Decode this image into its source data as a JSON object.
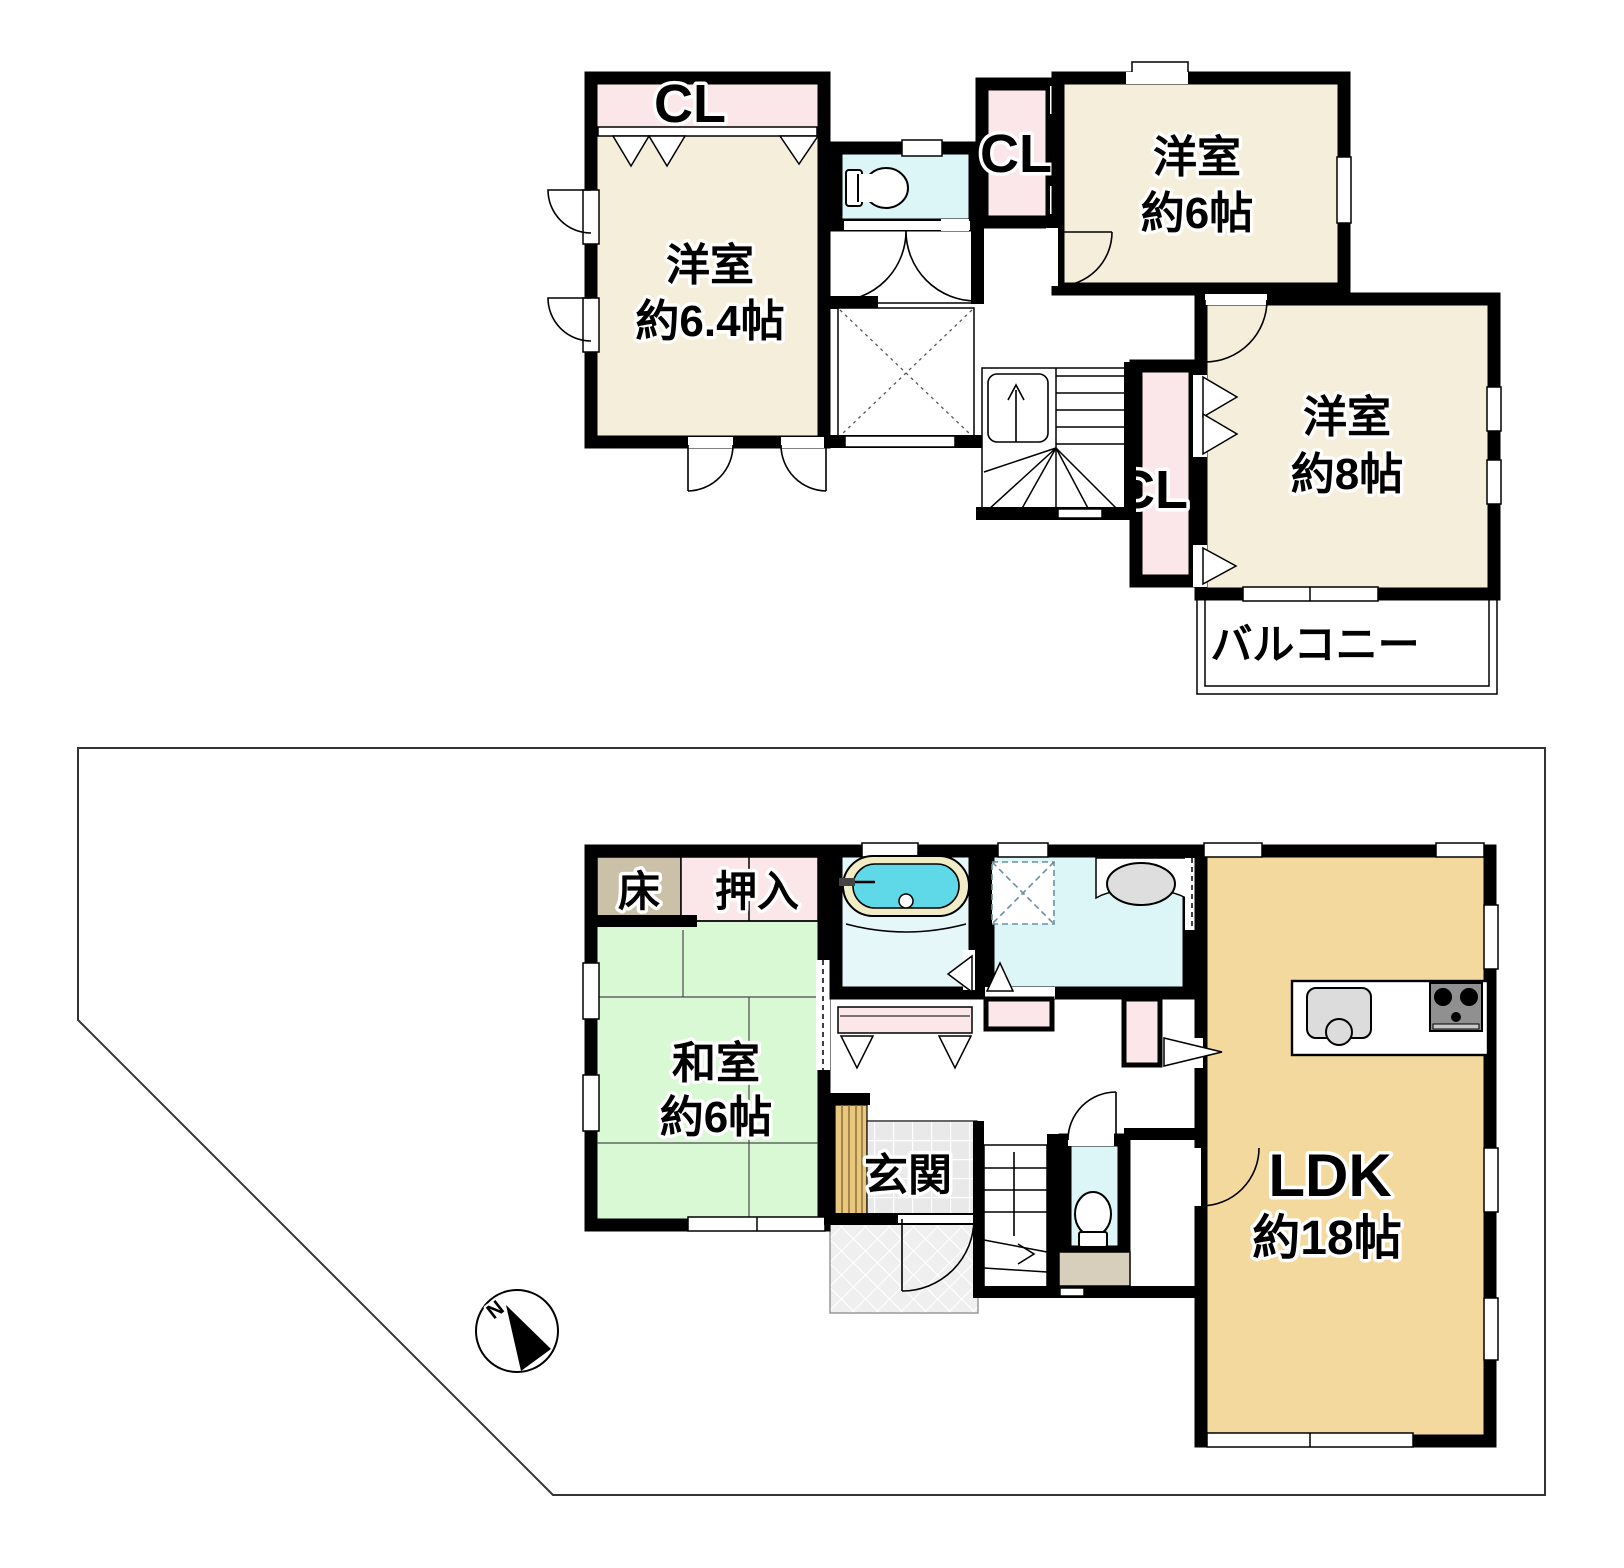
{
  "floor2": {
    "room_a_closet": "CL",
    "room_a": {
      "label": "洋室",
      "size": "約6.4帖"
    },
    "hall_closet": "CL",
    "room_b": {
      "label": "洋室",
      "size": "約6帖"
    },
    "room_c": {
      "label": "洋室",
      "size": "約8帖"
    },
    "room_c_closet": "CL",
    "balcony": "バルコニー"
  },
  "floor1": {
    "tokonoma": "床",
    "oshiire": "押入",
    "washitsu": {
      "label": "和室",
      "size": "約6帖"
    },
    "genkan": "玄関",
    "ldk": {
      "label": "LDK",
      "size": "約18帖"
    },
    "compass_north": "N"
  },
  "colors": {
    "wall": "#000000",
    "western_room": "#F5EEDA",
    "closet_pink": "#FBE7EA",
    "sanitary_cyan": "#DCF6F8",
    "bath_floor": "#E6F7F9",
    "tatami_green": "#D9F8D4",
    "ldk_tan": "#F4D99E",
    "tokonoma_tan": "#CBC0A8",
    "tub_water": "#5FD9E7",
    "tub_rim": "#F1ECC6",
    "wood_step": "#E8C77F",
    "tile_gray": "#E9E9E9",
    "porch_gray": "#EFEFEF"
  },
  "icons": {
    "toilet_2f": "toilet-icon",
    "toilet_1f": "toilet-icon",
    "bathtub": "bathtub-icon",
    "vanity_sink": "sink-icon",
    "washer_space": "washing-machine-icon",
    "kitchen_sink": "kitchen-sink-icon",
    "stove": "stove-icon",
    "stairs_2f": "stairs-icon",
    "stairs_1f": "stairs-icon",
    "compass": "compass-icon"
  }
}
